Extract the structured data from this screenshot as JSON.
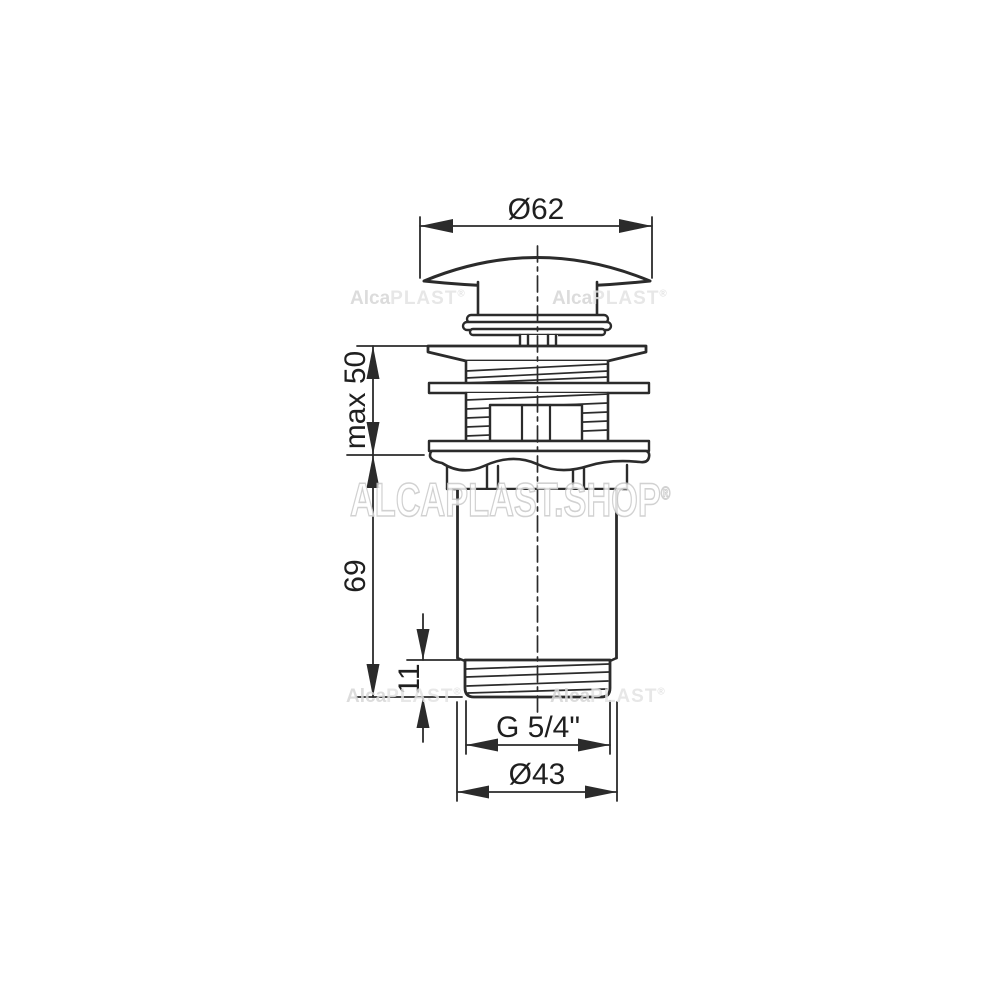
{
  "diagram": {
    "type": "technical-drawing",
    "background": "#ffffff",
    "line_color": "#2b2b2b",
    "text_color": "#1f1f1f",
    "dimensions": [
      {
        "id": "cap-diameter",
        "label": "Ø62"
      },
      {
        "id": "clamp-range",
        "label": "max 50"
      },
      {
        "id": "body-length",
        "label": "69"
      },
      {
        "id": "thread-length",
        "label": "11"
      },
      {
        "id": "outlet-thread",
        "label": "G 5/4\""
      },
      {
        "id": "outlet-diameter",
        "label": "Ø43"
      }
    ],
    "watermarks": {
      "brand_first": "Alca",
      "brand_second": "PLAST",
      "registered": "®",
      "shop_text": "ALCAPLAST.SHOP",
      "color": "#d6d6d6"
    }
  }
}
